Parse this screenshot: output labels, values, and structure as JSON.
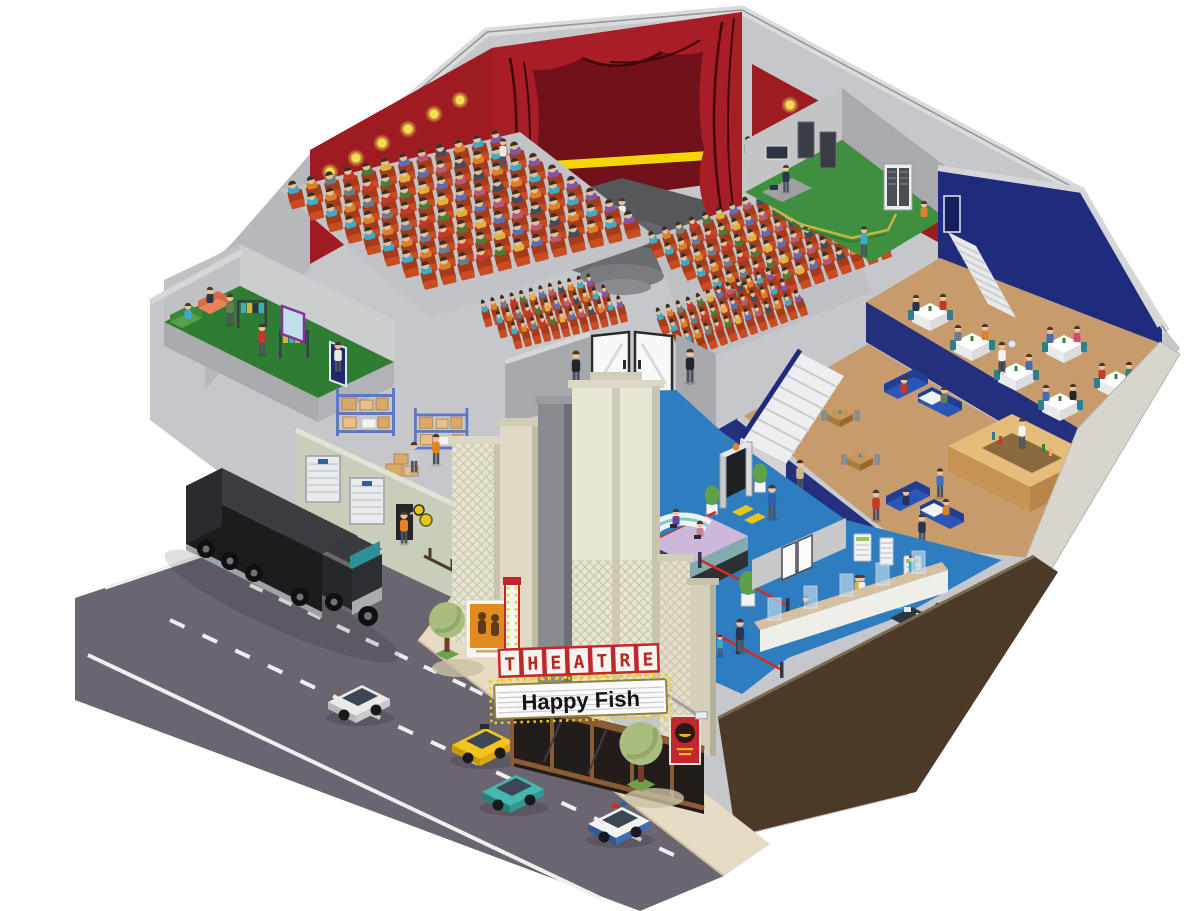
{
  "scene": {
    "description": "Isometric cutaway illustration of a theatre building showing auditorium, stage, restaurant, lobby, backstage and street",
    "marquee": {
      "top_line": "THEATRE",
      "bottom_line": "Happy Fish"
    }
  },
  "regions": [
    {
      "name": "auditorium",
      "detail": "stage with red curtains, performer, four blocks of red seats filled with audience, red walls with spotlights"
    },
    {
      "name": "control-room",
      "detail": "green-floored technical room with server racks, console and technicians"
    },
    {
      "name": "restaurant-mezzanine",
      "detail": "dining tables with white tablecloths, waiters, navy walls, tan floor"
    },
    {
      "name": "restaurant-ground-floor",
      "detail": "wooden bar counter, blue sofas, wooden tables, white staircase"
    },
    {
      "name": "lobby",
      "detail": "blue floor, security metal detector with topiary planters, ushers at white double doors"
    },
    {
      "name": "box-office",
      "detail": "glass ticket counter, red-rope queue, back office with desks, computers and copiers"
    },
    {
      "name": "reception-overlook",
      "detail": "curved white desk on lavender balcony floor"
    },
    {
      "name": "dressing-room",
      "detail": "green floor, costume racks, mirror, sofas"
    },
    {
      "name": "warehouse",
      "detail": "storage racks with boxes, roller shutter loading doors, workers in orange overalls"
    },
    {
      "name": "facade",
      "detail": "art-deco cream pillars, marquee sign, posters, dark storefront"
    },
    {
      "name": "street",
      "detail": "grey road with white lane markings, sidewalk with trees"
    }
  ],
  "seating": {
    "left_block_rows": 8,
    "right_block_rows": 6,
    "front_left_rows": 3,
    "front_right_rows": 3,
    "seats_per_full_row": 12
  },
  "street": {
    "vehicles": [
      "black semi-trailer truck",
      "white car",
      "yellow taxi",
      "teal car",
      "police car"
    ]
  },
  "palette": {
    "wall_red": "#9E1B22",
    "curtain_red": "#A81D26",
    "stage_dark": "#56575A",
    "seat_red": "#C84B22",
    "lobby_blue": "#2F7DC1",
    "navy_wall": "#1F2C7E",
    "restaurant_floor_tan": "#C79B6B",
    "room_green": "#3E8F3F",
    "structure_grey": "#C6C7CA",
    "facade_cream": "#E8E4D2",
    "road_grey": "#6B6570",
    "sidewalk_beige": "#E6DCC3",
    "cross_section_brown": "#4A3A27",
    "marquee_letter_red": "#B5281E",
    "bulb_yellow": "#F2CC1C"
  }
}
